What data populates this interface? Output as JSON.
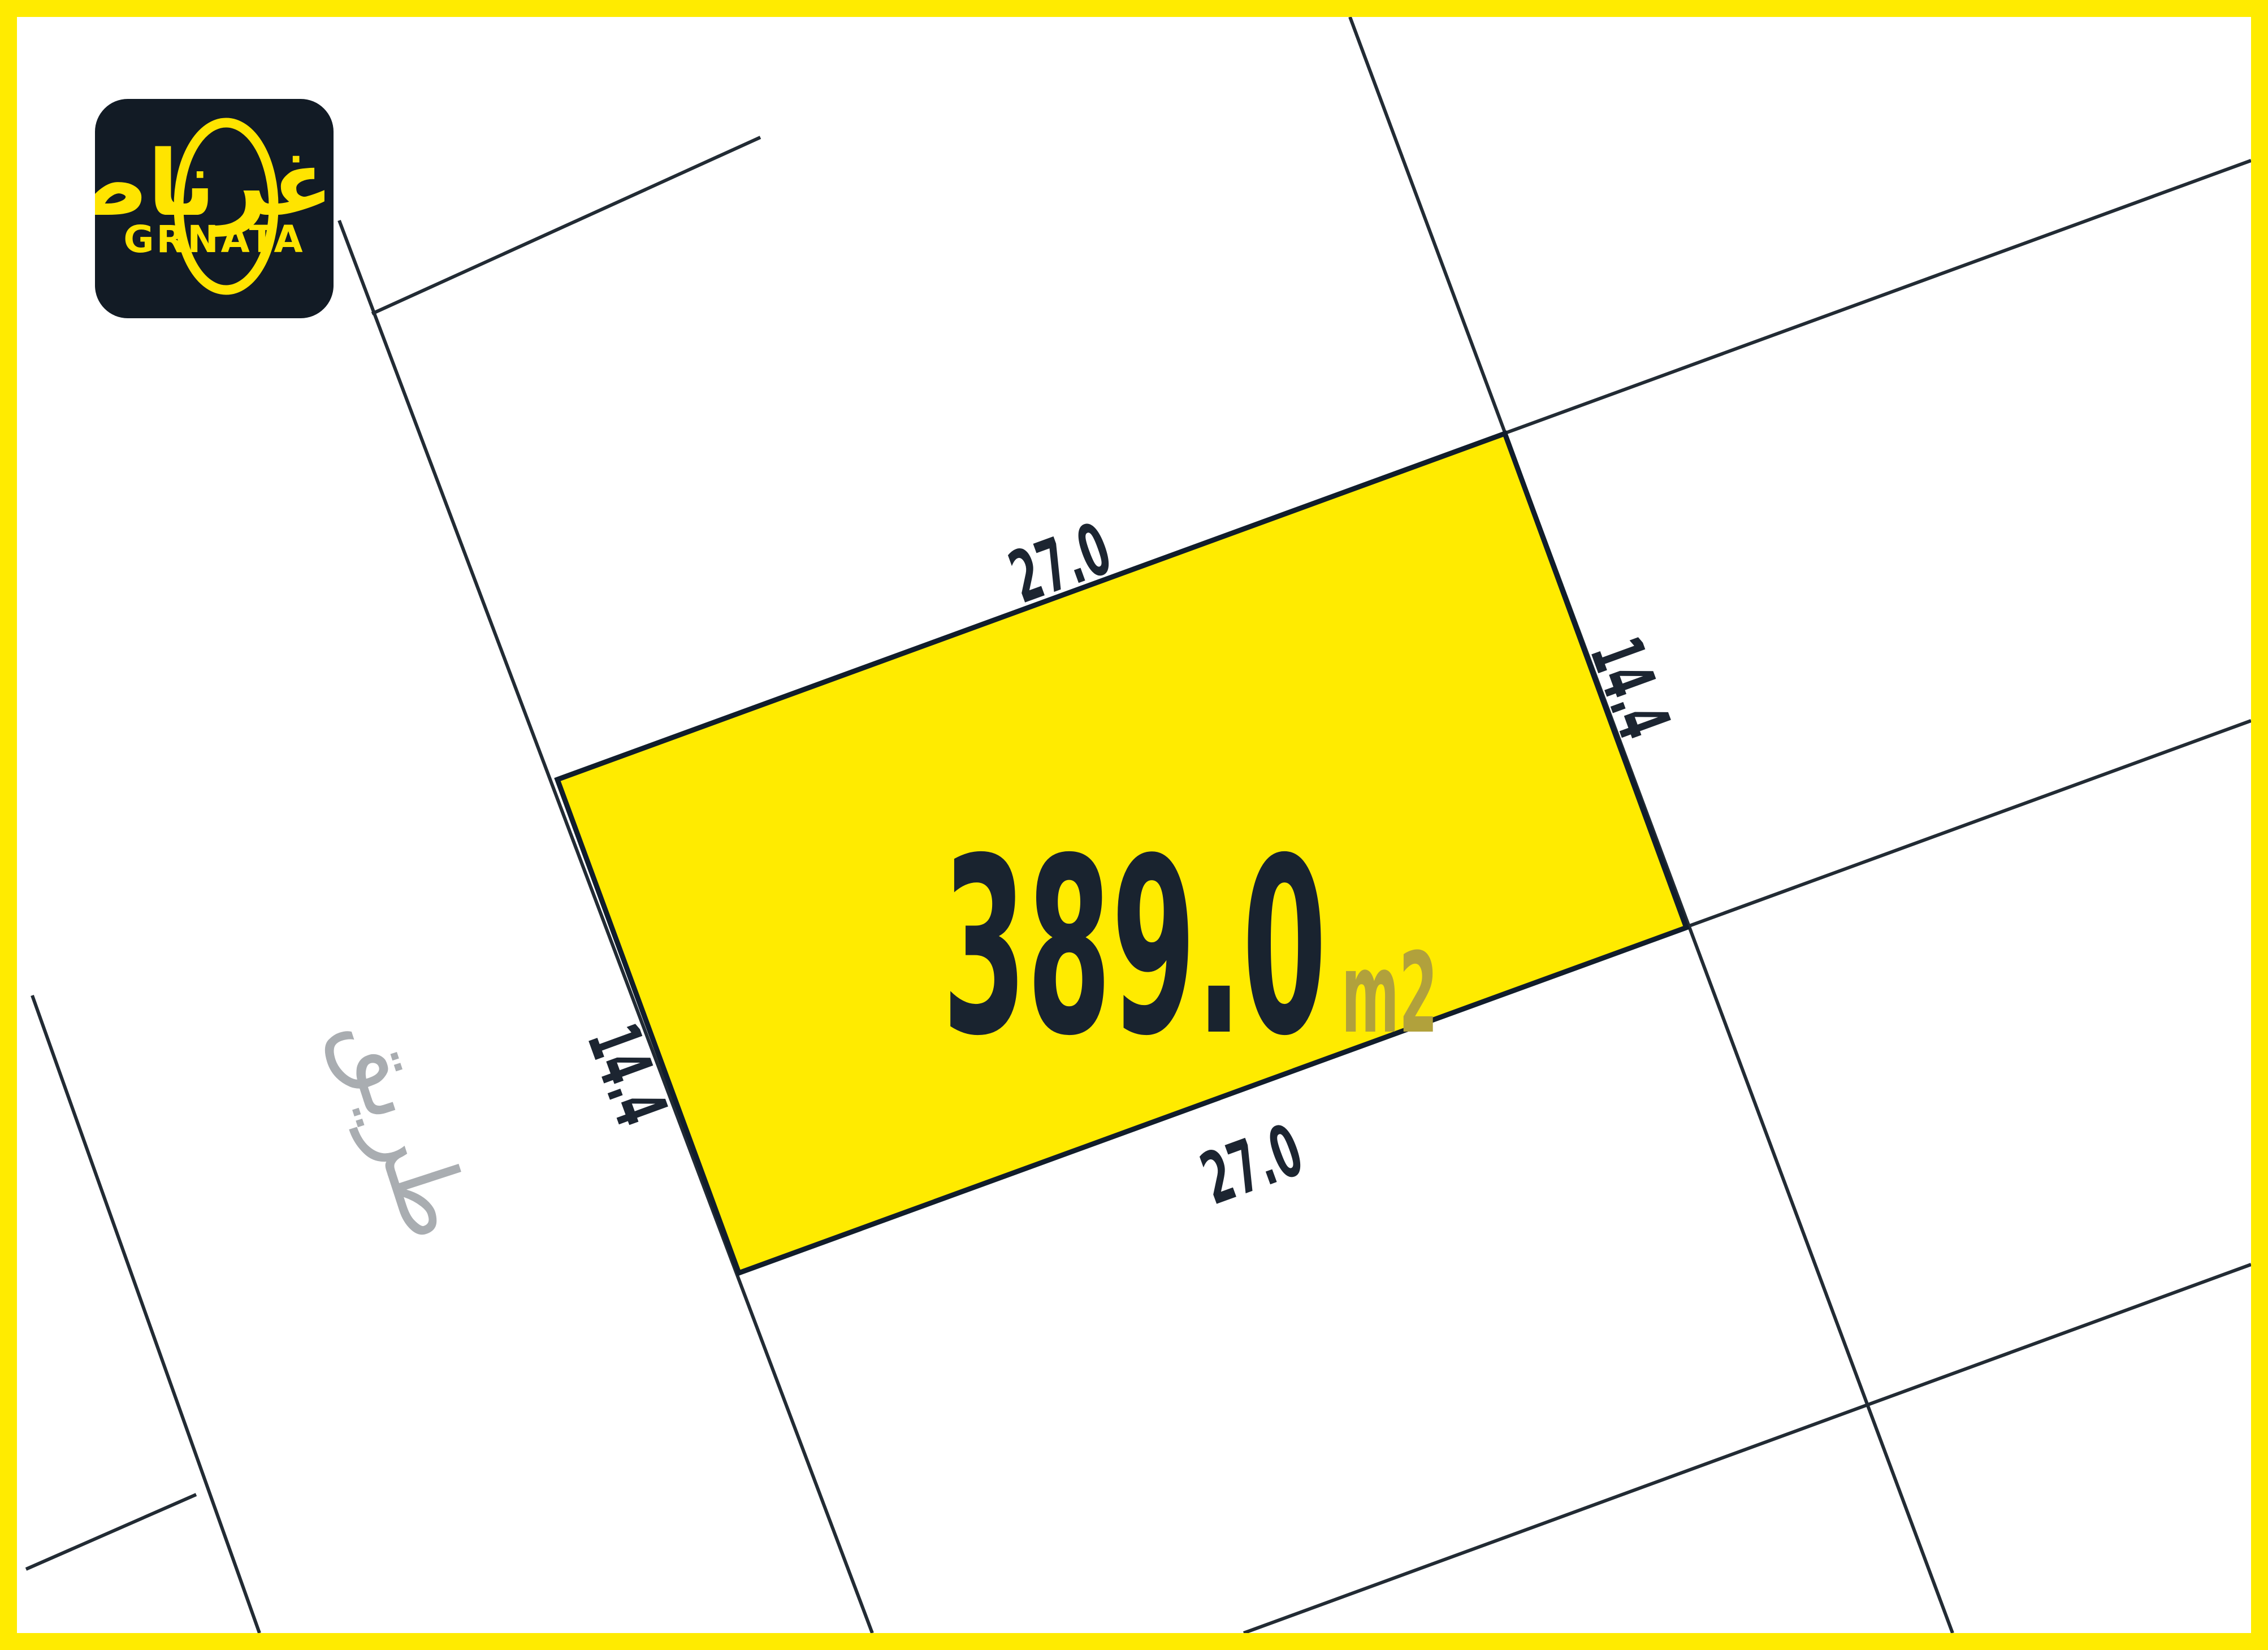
{
  "map": {
    "plot": {
      "area_value": "389.0",
      "area_unit": "m2",
      "dim_top": "27.0",
      "dim_bottom": "27.0",
      "dim_left": "14.4",
      "dim_right": "14.4"
    },
    "road_label": "طريق"
  },
  "logo": {
    "arabic_name": "غرناطة",
    "latin_name": "GRNATA"
  },
  "colors": {
    "frame_yellow": "#FFEB00",
    "plot_fill": "#FFEB00",
    "line_dark": "#222B34",
    "plot_outline": "#111D2B",
    "area_text": "#19232F",
    "dim_text": "#1C2531",
    "unit_text": "#B1A13C",
    "road_text": "#A9ADB1",
    "logo_bg": "#121B25",
    "logo_yellow": "#FFE400",
    "paper": "#FFFFFF"
  }
}
